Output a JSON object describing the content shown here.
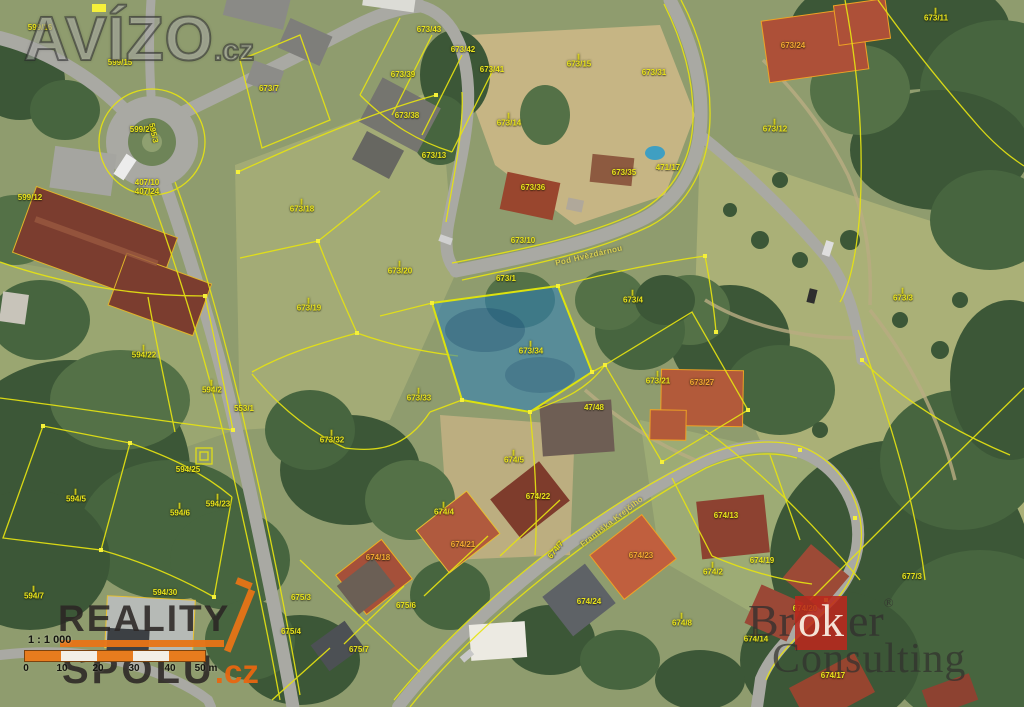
{
  "map": {
    "type": "cadastral-aerial",
    "highlighted_parcel": "673/34",
    "street_names": [
      "Pod Hvězdárnou",
      "Františka Krejčího"
    ],
    "colors": {
      "parcel_line_yellow": "#e6e312",
      "highlight_blue_fill": "#2c80bc",
      "highlight_opacity": "0.55",
      "orange_house_outline": "#efa224",
      "logo_orange": "#e87416",
      "logo_red": "#ba281e"
    },
    "labels": [
      {
        "t": "599/16",
        "x": 40,
        "y": 28
      },
      {
        "t": "599/15",
        "x": 120,
        "y": 63
      },
      {
        "t": "599/12",
        "x": 30,
        "y": 198
      },
      {
        "t": "599/26",
        "x": 142,
        "y": 130
      },
      {
        "t": "407/10",
        "x": 147,
        "y": 183
      },
      {
        "t": "407/24",
        "x": 147,
        "y": 192
      },
      {
        "t": "595/3",
        "x": 153,
        "y": 133,
        "rot": 78
      },
      {
        "t": "594/22",
        "x": 144,
        "y": 353,
        "m": true
      },
      {
        "t": "594/2",
        "x": 212,
        "y": 388,
        "m": true
      },
      {
        "t": "553/1",
        "x": 244,
        "y": 409
      },
      {
        "t": "594/25",
        "x": 188,
        "y": 470
      },
      {
        "t": "594/23",
        "x": 218,
        "y": 502,
        "m": true
      },
      {
        "t": "594/5",
        "x": 76,
        "y": 497,
        "m": true
      },
      {
        "t": "594/6",
        "x": 180,
        "y": 511,
        "m": true
      },
      {
        "t": "594/7",
        "x": 34,
        "y": 594,
        "m": true
      },
      {
        "t": "594/30",
        "x": 165,
        "y": 593
      },
      {
        "t": "673/18",
        "x": 302,
        "y": 207,
        "m": true
      },
      {
        "t": "673/19",
        "x": 309,
        "y": 306,
        "m": true
      },
      {
        "t": "673/20",
        "x": 400,
        "y": 269,
        "m": true
      },
      {
        "t": "673/33",
        "x": 419,
        "y": 396,
        "m": true
      },
      {
        "t": "673/32",
        "x": 332,
        "y": 438,
        "m": true
      },
      {
        "t": "673/34",
        "x": 531,
        "y": 349,
        "m": true
      },
      {
        "t": "673/4",
        "x": 633,
        "y": 298,
        "m": true
      },
      {
        "t": "673/21",
        "x": 658,
        "y": 379,
        "m": true
      },
      {
        "t": "673/27",
        "x": 702,
        "y": 383,
        "tone": "orange"
      },
      {
        "t": "47/48",
        "x": 594,
        "y": 408
      },
      {
        "t": "673/3",
        "x": 903,
        "y": 296,
        "m": true
      },
      {
        "t": "673/11",
        "x": 936,
        "y": 16,
        "m": true
      },
      {
        "t": "673/12",
        "x": 775,
        "y": 127,
        "m": true
      },
      {
        "t": "673/24",
        "x": 793,
        "y": 46,
        "tone": "orange"
      },
      {
        "t": "673/31",
        "x": 654,
        "y": 73
      },
      {
        "t": "673/15",
        "x": 579,
        "y": 62,
        "m": true
      },
      {
        "t": "673/14",
        "x": 509,
        "y": 121,
        "m": true
      },
      {
        "t": "673/38",
        "x": 407,
        "y": 116
      },
      {
        "t": "673/43",
        "x": 429,
        "y": 30
      },
      {
        "t": "673/42",
        "x": 463,
        "y": 50
      },
      {
        "t": "673/41",
        "x": 492,
        "y": 70
      },
      {
        "t": "673/39",
        "x": 403,
        "y": 75
      },
      {
        "t": "673/7",
        "x": 269,
        "y": 89
      },
      {
        "t": "673/13",
        "x": 434,
        "y": 156
      },
      {
        "t": "673/36",
        "x": 533,
        "y": 188
      },
      {
        "t": "673/35",
        "x": 624,
        "y": 173
      },
      {
        "t": "471/17",
        "x": 668,
        "y": 168
      },
      {
        "t": "673/10",
        "x": 523,
        "y": 241
      },
      {
        "t": "673/1",
        "x": 506,
        "y": 279
      },
      {
        "t": "674/4",
        "x": 444,
        "y": 510,
        "m": true
      },
      {
        "t": "674/5",
        "x": 514,
        "y": 458,
        "m": true
      },
      {
        "t": "674/18",
        "x": 378,
        "y": 558,
        "tone": "orange"
      },
      {
        "t": "674/21",
        "x": 463,
        "y": 545,
        "tone": "orange"
      },
      {
        "t": "674/22",
        "x": 538,
        "y": 497
      },
      {
        "t": "674/7",
        "x": 556,
        "y": 550,
        "rot": -52
      },
      {
        "t": "674/13",
        "x": 726,
        "y": 516
      },
      {
        "t": "674/23",
        "x": 641,
        "y": 556,
        "tone": "orange"
      },
      {
        "t": "674/24",
        "x": 589,
        "y": 602
      },
      {
        "t": "674/2",
        "x": 713,
        "y": 570,
        "m": true
      },
      {
        "t": "674/19",
        "x": 762,
        "y": 561
      },
      {
        "t": "674/8",
        "x": 682,
        "y": 621,
        "m": true
      },
      {
        "t": "674/14",
        "x": 756,
        "y": 637,
        "m": true
      },
      {
        "t": "674/20",
        "x": 805,
        "y": 609
      },
      {
        "t": "674/17",
        "x": 833,
        "y": 676
      },
      {
        "t": "677/3",
        "x": 912,
        "y": 577
      },
      {
        "t": "675/3",
        "x": 301,
        "y": 598
      },
      {
        "t": "675/4",
        "x": 291,
        "y": 632
      },
      {
        "t": "675/7",
        "x": 359,
        "y": 650
      },
      {
        "t": "675/6",
        "x": 406,
        "y": 606
      },
      {
        "t": "Pod Hvězdárnou",
        "x": 589,
        "y": 256,
        "rot": -13,
        "street": true
      },
      {
        "t": "Františka Krejčího",
        "x": 612,
        "y": 522,
        "rot": -38,
        "street": true
      }
    ]
  },
  "watermarks": {
    "avizo": {
      "text": "AVÍZO",
      "suffix": ".cz"
    },
    "reality": {
      "line1": "REALITY",
      "line2": "SPOLU",
      "suffix": ".cz"
    },
    "broker": {
      "pre": "Br",
      "mid": "ok",
      "post": "er",
      "reg": "®",
      "line2": "Consulting"
    }
  },
  "scalebar": {
    "ratio_text": "1 : 1 000",
    "tick_labels": [
      "0",
      "10",
      "20",
      "30",
      "40",
      "50 m"
    ]
  }
}
